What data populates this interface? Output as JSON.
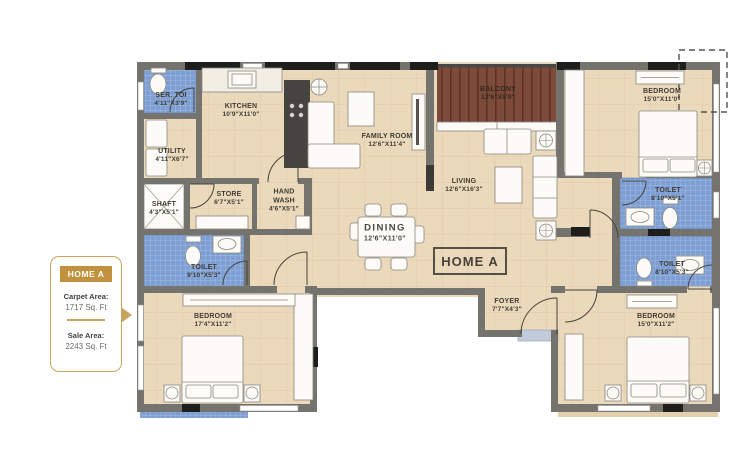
{
  "side_panel": {
    "badge": "HOME A",
    "carpet_area_label": "Carpet Area:",
    "carpet_area_value": "1717 Sq. Ft",
    "sale_area_label": "Sale Area:",
    "sale_area_value": "2243 Sq. Ft"
  },
  "plan": {
    "unit_label": "HOME A",
    "rooms": {
      "ser_toi": {
        "name": "SER. TOI",
        "dims": "4'11\"X3'9\""
      },
      "kitchen": {
        "name": "KITCHEN",
        "dims": "10'9\"X11'0\""
      },
      "utility": {
        "name": "UTILITY",
        "dims": "4'11\"X6'7\""
      },
      "shaft": {
        "name": "SHAFT",
        "dims": "4'3\"X5'1\""
      },
      "store": {
        "name": "STORE",
        "dims": "6'7\"X5'1\""
      },
      "hand_wash": {
        "name": "HAND WASH",
        "dims": "4'6\"X5'1\""
      },
      "family_room": {
        "name": "FAMILY ROOM",
        "dims": "12'6\"X11'4\""
      },
      "balcony": {
        "name": "BALCONY",
        "dims": "12'6\"X5'9\""
      },
      "living": {
        "name": "LIVING",
        "dims": "12'6\"X16'3\""
      },
      "dining": {
        "name": "DINING",
        "dims": "12'6\"X11'0\""
      },
      "bedroom_top_right": {
        "name": "BEDROOM",
        "dims": "15'0\"X11'0\""
      },
      "toilet_right_upper": {
        "name": "TOILET",
        "dims": "8'10\"X5'1\""
      },
      "toilet_right_lower": {
        "name": "TOILET",
        "dims": "8'10\"X5'3\""
      },
      "bedroom_bottom_right": {
        "name": "BEDROOM",
        "dims": "15'0\"X11'2\""
      },
      "foyer": {
        "name": "FOYER",
        "dims": "7'7\"X4'3\""
      },
      "toilet_left": {
        "name": "TOILET",
        "dims": "9'10\"X5'3\""
      },
      "bedroom_bottom_left": {
        "name": "BEDROOM",
        "dims": "17'4\"X11'2\""
      }
    }
  },
  "colors": {
    "floor_tan": "#ebd9bc",
    "wall_gray": "#75736d",
    "toilet_tile_blue": "#7e9fd3",
    "balcony_wood": "#7c4b39",
    "accent_gold": "#c9a45c",
    "badge_gold": "#c2913e",
    "label_text": "#3f3c35"
  }
}
